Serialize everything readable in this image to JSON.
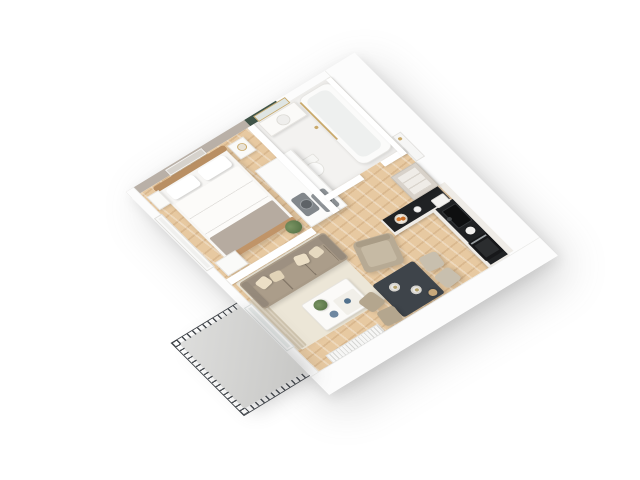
{
  "scene": {
    "type": "3d-isometric-floor-plan-render",
    "background_color": "#ffffff",
    "rooms": [
      {
        "name": "bedroom",
        "furniture": [
          "double-bed",
          "headboard",
          "pillows",
          "greige-throw",
          "nightstand-left",
          "nightstand-right",
          "wall-art",
          "accent-wall",
          "window",
          "dresser",
          "plant"
        ]
      },
      {
        "name": "bathroom",
        "furniture": [
          "vanity",
          "mirror",
          "bathtub",
          "gold-shower-screen",
          "toilet",
          "green-accent-wall",
          "washer-dryer-tower"
        ]
      },
      {
        "name": "entry-hall",
        "furniture": [
          "entrance-door",
          "gold-door-handle",
          "tall-storage-cabinet"
        ]
      },
      {
        "name": "kitchen",
        "furniture": [
          "l-shaped-black-counter",
          "white-cabinets",
          "sink",
          "faucet",
          "kettle",
          "coffee-machine",
          "oven",
          "fruit-bowl"
        ]
      },
      {
        "name": "living-room",
        "furniture": [
          "sofa",
          "sofa-pillows",
          "cream-rug",
          "coffee-table",
          "table-plant",
          "decor-tray",
          "armchair",
          "curtain",
          "radiator",
          "panoramic-window"
        ]
      },
      {
        "name": "dining-area",
        "furniture": [
          "dark-dining-table",
          "plates",
          "pampas-vase",
          "chair-1",
          "chair-2",
          "chair-3",
          "chair-4"
        ]
      },
      {
        "name": "balcony",
        "furniture": [
          "concrete-floor",
          "metal-bar-railing",
          "glass-balcony-door"
        ]
      }
    ],
    "palette": {
      "background": "#ffffff",
      "walls": "#fdfdfd",
      "wood_floor": "#e7c9a1",
      "bath_floor": "#f3f2f0",
      "balcony_floor": "#d2d2d0",
      "railing": "#45494e",
      "bedroom_accent_wall": "#b9b0a7",
      "bathroom_accent_wall": "#3f5347",
      "gold_fixtures": "#c9a96a",
      "sofa": "#a89a87",
      "pillow_cream": "#ecdfc6",
      "rug": "#ece6d7",
      "armchair": "#b7aa94",
      "dining_table": "#3e444a",
      "chair": "#c8bfae",
      "kitchen_counter": "#202224",
      "kitchen_cabinet": "#efece7",
      "oven": "#17181a",
      "appliance_gray": "#82878b",
      "bed_frame_wood": "#b98f63",
      "plant_green": "#5d7a4e",
      "fruit_orange": "#d97e33"
    }
  }
}
